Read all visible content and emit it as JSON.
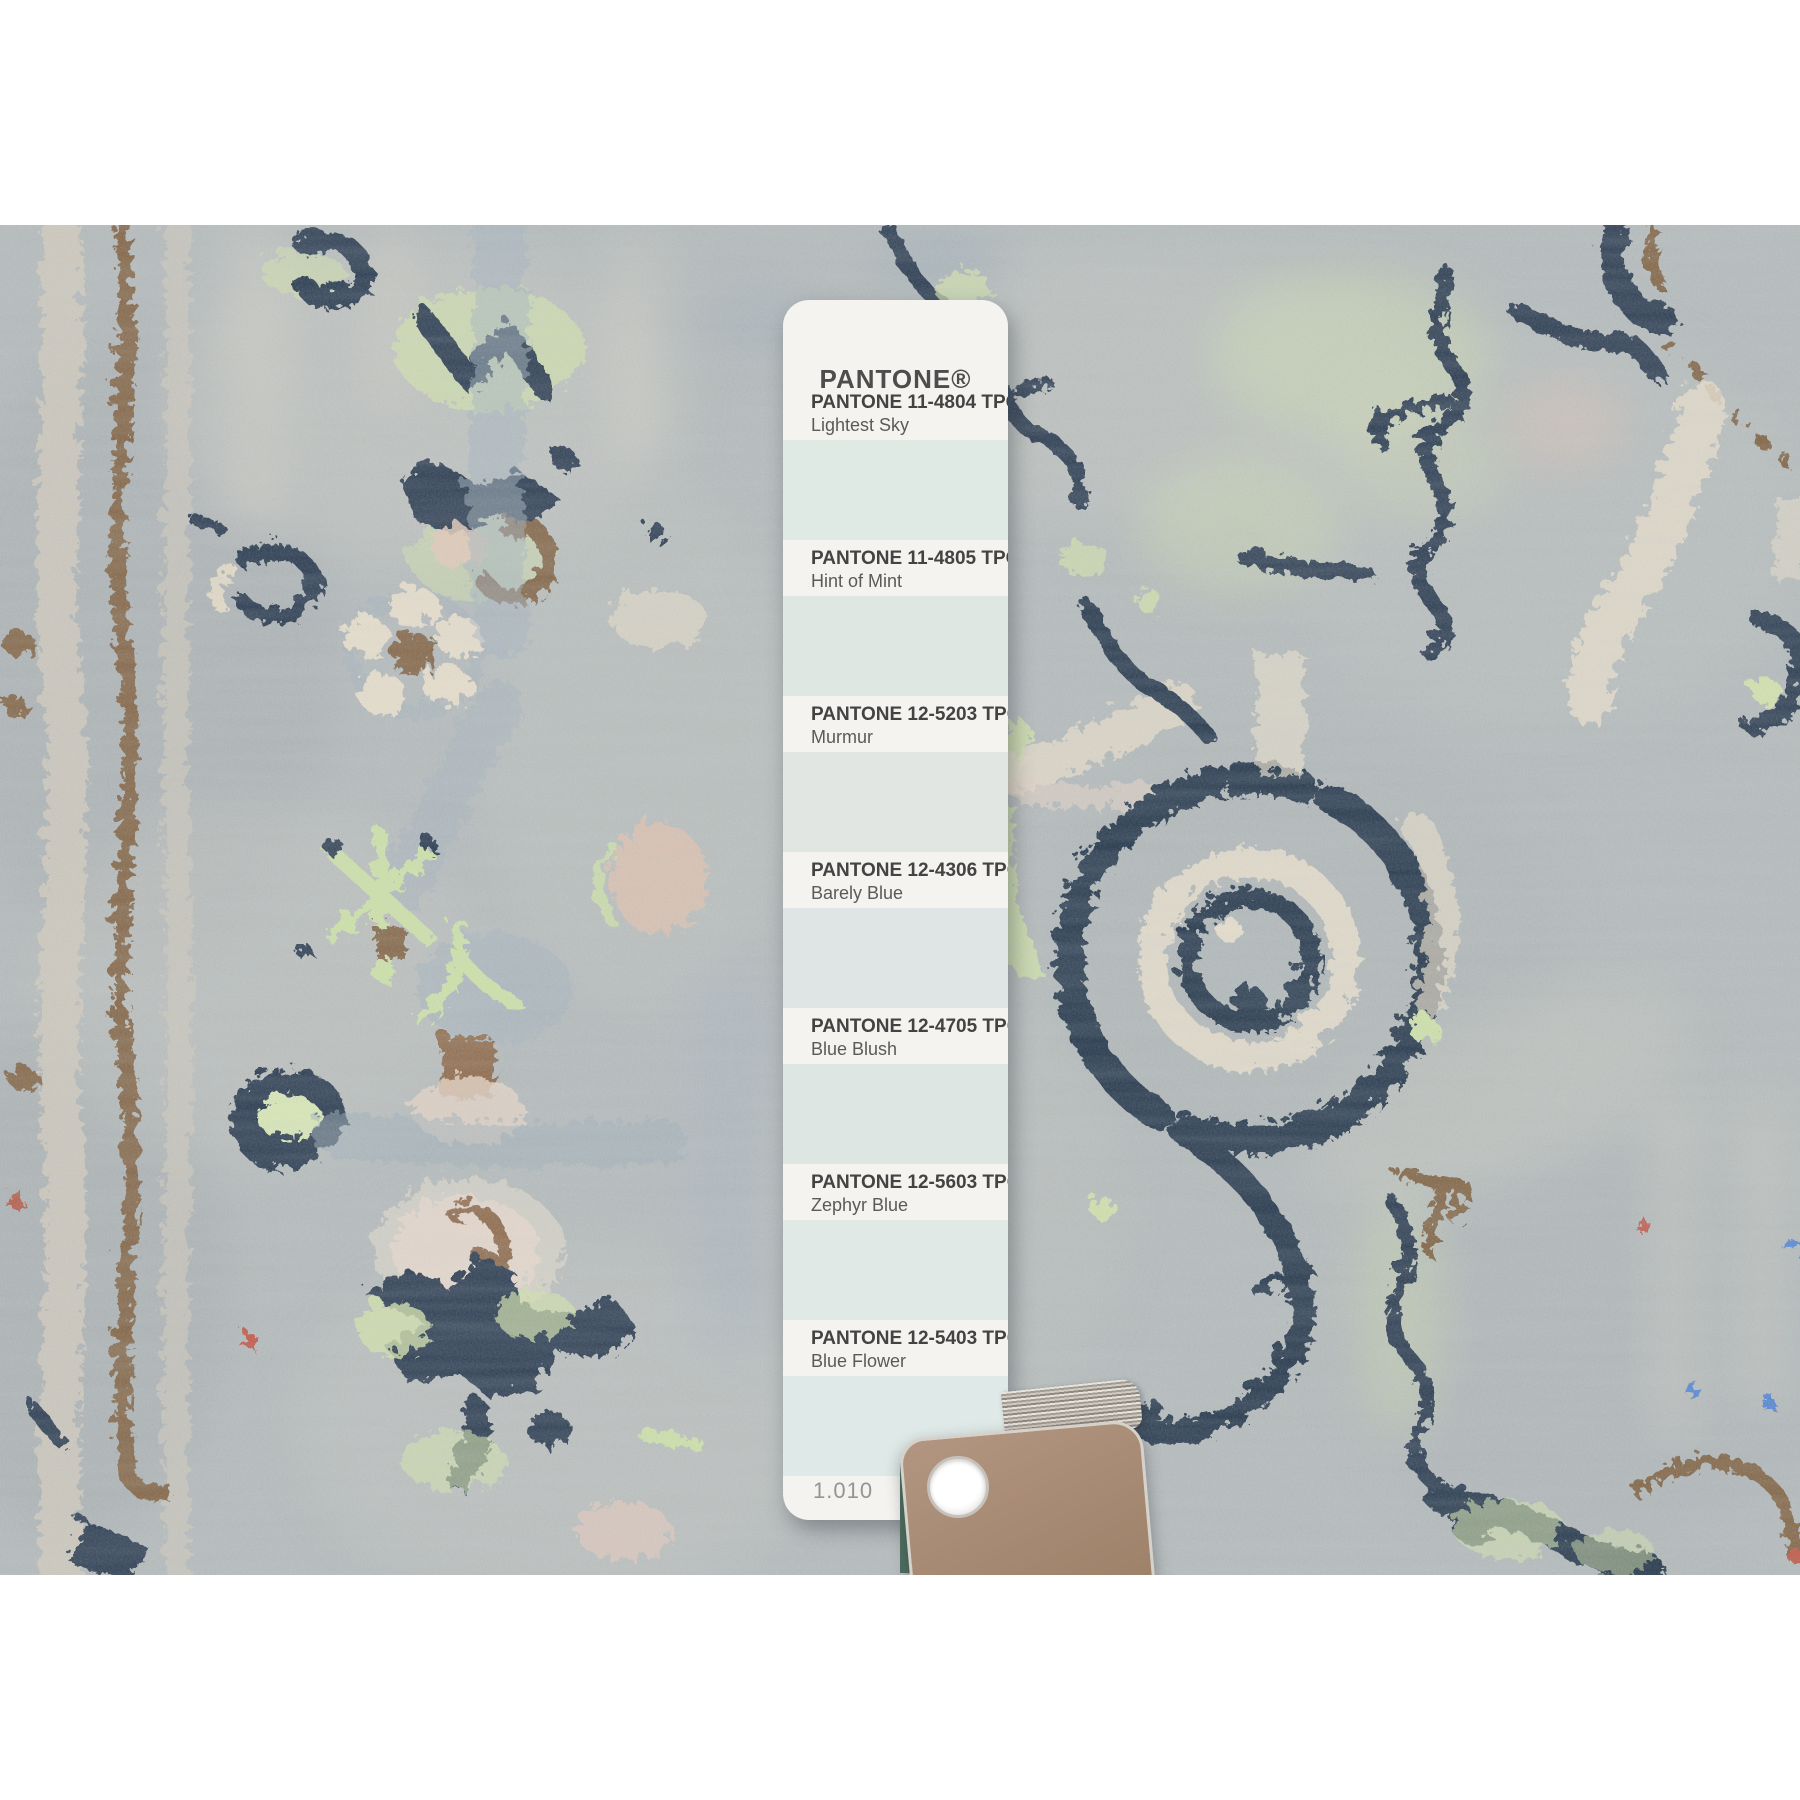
{
  "photo": {
    "description": "Close-up photograph of a hand-knotted gray wool oriental rug with navy blue flower and vine motifs, lime green and cream accents and brown details",
    "palette": {
      "field_gray": "#b2b8b9",
      "navy": "#1c2e45",
      "lime_green": "#d2e3a5",
      "cream": "#e8decb",
      "brown": "#7c5b3a",
      "blush_pink": "#e4c4b1",
      "blue_gray": "#9fb0bd",
      "knot_blue": "#4a7fd4",
      "knot_red": "#bf4a35"
    }
  },
  "strip": {
    "brand": "PANTONE®",
    "page_number": "1.010",
    "swatches": [
      {
        "code": "PANTONE 11-4804 TPG",
        "name": "Lightest Sky",
        "hex": "#dfeae5"
      },
      {
        "code": "PANTONE 11-4805 TPG",
        "name": "Hint of Mint",
        "hex": "#dee7e2"
      },
      {
        "code": "PANTONE 12-5203 TPG",
        "name": "Murmur",
        "hex": "#e2e6e3"
      },
      {
        "code": "PANTONE 12-4306 TPG",
        "name": "Barely Blue",
        "hex": "#dee5e4"
      },
      {
        "code": "PANTONE 12-4705 TPG",
        "name": "Blue Blush",
        "hex": "#dee6e4"
      },
      {
        "code": "PANTONE 12-5603 TPG",
        "name": "Zephyr Blue",
        "hex": "#e0e9e6"
      },
      {
        "code": "PANTONE 12-5403 TPG",
        "name": "Blue Flower",
        "hex": "#dfe9e7"
      }
    ],
    "deck_card_color": "#a98c76"
  }
}
